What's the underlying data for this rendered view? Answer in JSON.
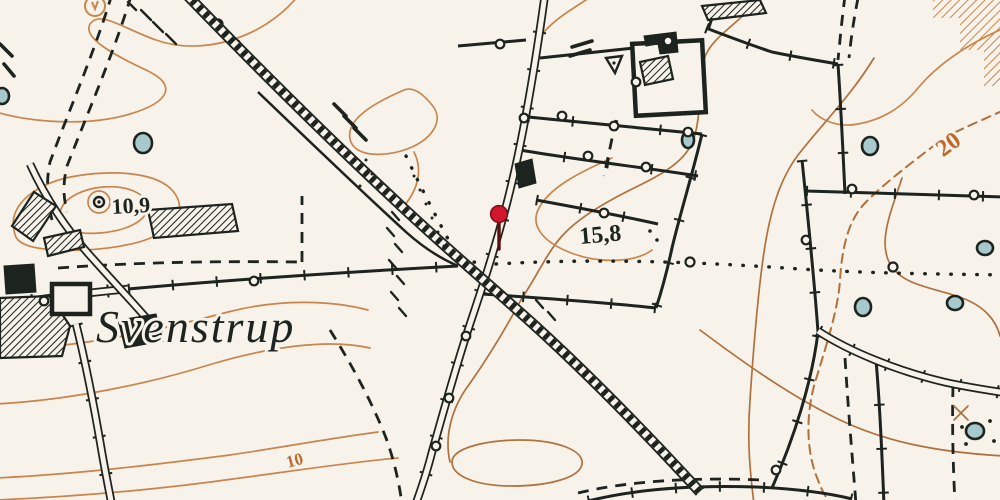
{
  "labels": {
    "place": "Svenstrup",
    "spot_height_west": "10,9",
    "spot_height_center": "15,8",
    "contour_label_20": "20",
    "contour_label_10": "10"
  },
  "marker": {
    "name": "location-pin",
    "color": "#d2182d"
  },
  "colors": {
    "paper": "#f7f2ea",
    "ink": "#1d231e",
    "contour_light": "#c9854c",
    "contour_dark": "#b0713d",
    "contour_label": "#bd6a2a",
    "water": "#a7c9cd",
    "pin_red": "#d2182d",
    "pin_stem": "#5a0e12"
  }
}
